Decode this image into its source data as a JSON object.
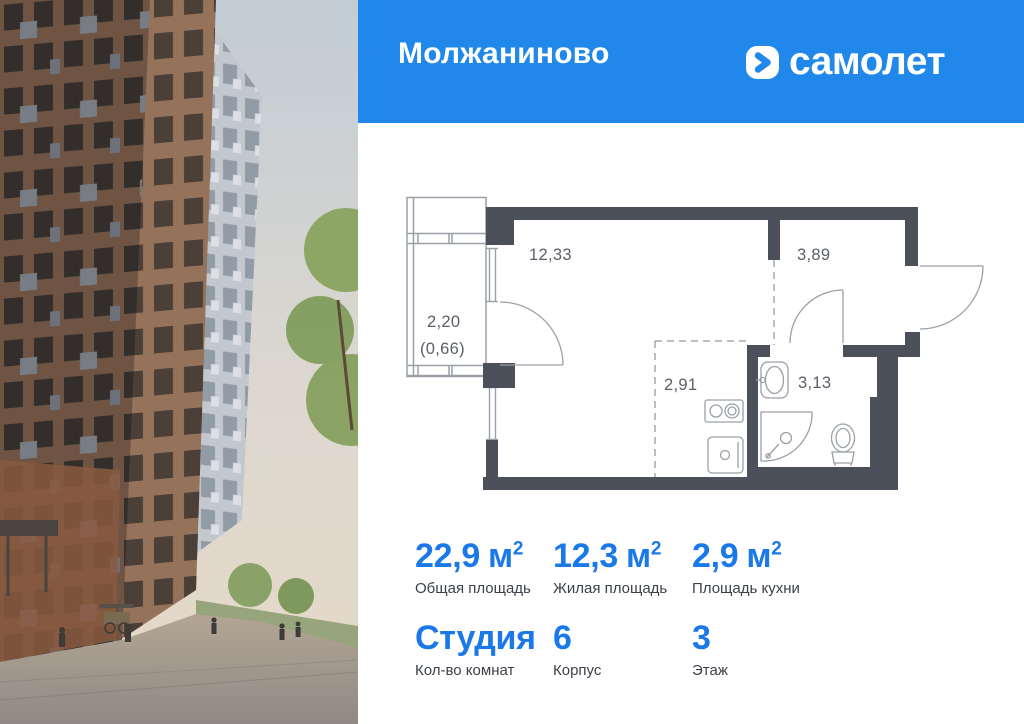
{
  "header": {
    "project_name": "Молжаниново",
    "brand_name": "самолет"
  },
  "floor_plan": {
    "living_room_area": "12,33",
    "hallway_area": "3,89",
    "balcony_area": "2,20",
    "balcony_reduced_area": "(0,66)",
    "kitchen_area": "2,91",
    "bathroom_area": "3,13"
  },
  "stats": {
    "total_area": {
      "value": "22,9",
      "unit": "м",
      "sup": "2",
      "label": "Общая площадь"
    },
    "living_area": {
      "value": "12,3",
      "unit": "м",
      "sup": "2",
      "label": "Жилая площадь"
    },
    "kitchen_area": {
      "value": "2,9",
      "unit": "м",
      "sup": "2",
      "label": "Площадь кухни"
    },
    "rooms": {
      "value": "Студия",
      "unit": "",
      "sup": "",
      "label": "Кол-во комнат"
    },
    "building": {
      "value": "6",
      "unit": "",
      "sup": "",
      "label": "Корпус"
    },
    "floor": {
      "value": "3",
      "unit": "",
      "sup": "",
      "label": "Этаж"
    }
  },
  "colors": {
    "brand_blue": "#1f88ea",
    "value_blue": "#1a78e8",
    "wall_dark": "#4b505a"
  }
}
